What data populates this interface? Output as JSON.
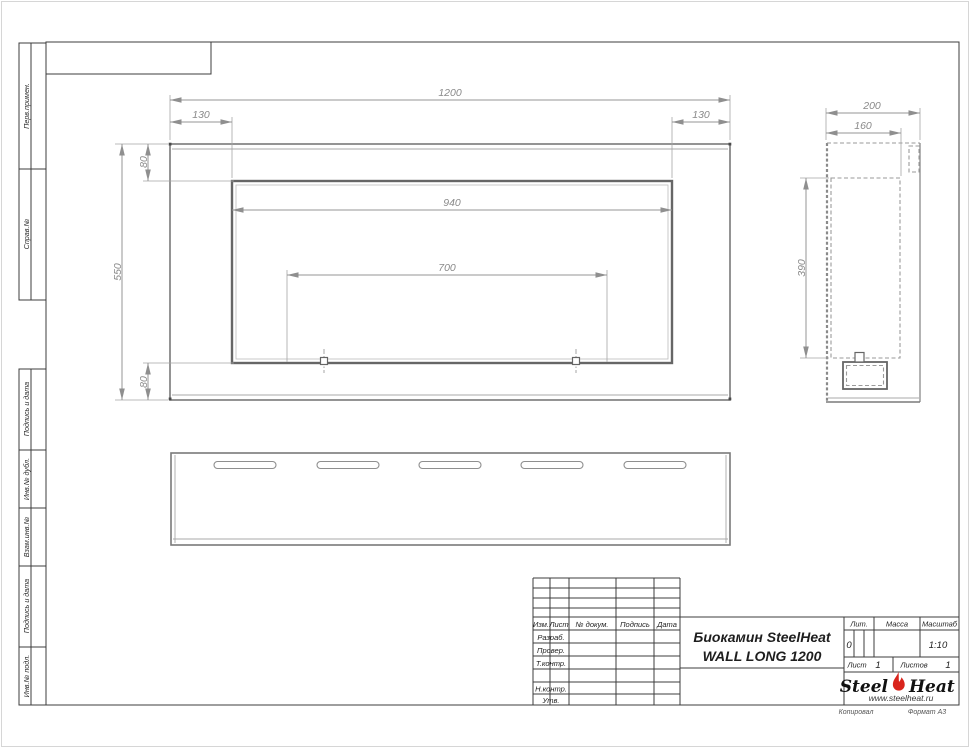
{
  "document": {
    "type": "GOST technical drawing",
    "product_title_line1": "Биокамин SteelHeat",
    "product_title_line2": "WALL LONG 1200"
  },
  "left_stamps": {
    "perv_primen": "Перв.примен.",
    "sprav_no": "Справ.№",
    "podpis_data_1": "Подпись и дата",
    "inv_dubl": "Инв.№ дубл.",
    "vzam_inv": "Взам.инв.№",
    "podpis_data_2": "Подпись и дата",
    "inv_podl": "Инв.№ подл."
  },
  "title_block": {
    "cols": {
      "izm": "Изм.",
      "list": "Лист",
      "doc": "№ докум.",
      "podpis": "Подпись",
      "data": "Дата"
    },
    "rows": {
      "razrab": "Разраб.",
      "prover": "Провер.",
      "tkontr": "Т.контр.",
      "nkontr": "Н.контр.",
      "utv": "Утв."
    },
    "lit_label": "Лит.",
    "lit_value": "0",
    "massa_label": "Масса",
    "scale_label": "Масштаб",
    "scale_value": "1:10",
    "sheet_label": "Лист",
    "sheet_value": "1",
    "sheets_label": "Листов",
    "sheets_value": "1"
  },
  "logo": {
    "part1": "Steel",
    "part2": "Heat",
    "url": "www.steelheat.ru",
    "flame_color": "#d9251c"
  },
  "footer": {
    "copied_label": "Копировал",
    "format_label": "Формат А3"
  },
  "drawing_dimensions_mm": {
    "front_view": {
      "overall_width": "1200",
      "margin_left": "130",
      "margin_right": "130",
      "flange_top": "80",
      "overall_height": "550",
      "opening_width": "940",
      "burner_span": "700",
      "flange_bottom": "80"
    },
    "side_view": {
      "depth": "200",
      "inner_depth": "160",
      "opening_height": "390"
    }
  },
  "colors": {
    "frame": "#3c3c3c",
    "geometry": "#6e6e6e",
    "dimension": "#8f8f8f",
    "flame_accent": "#d9251c"
  }
}
